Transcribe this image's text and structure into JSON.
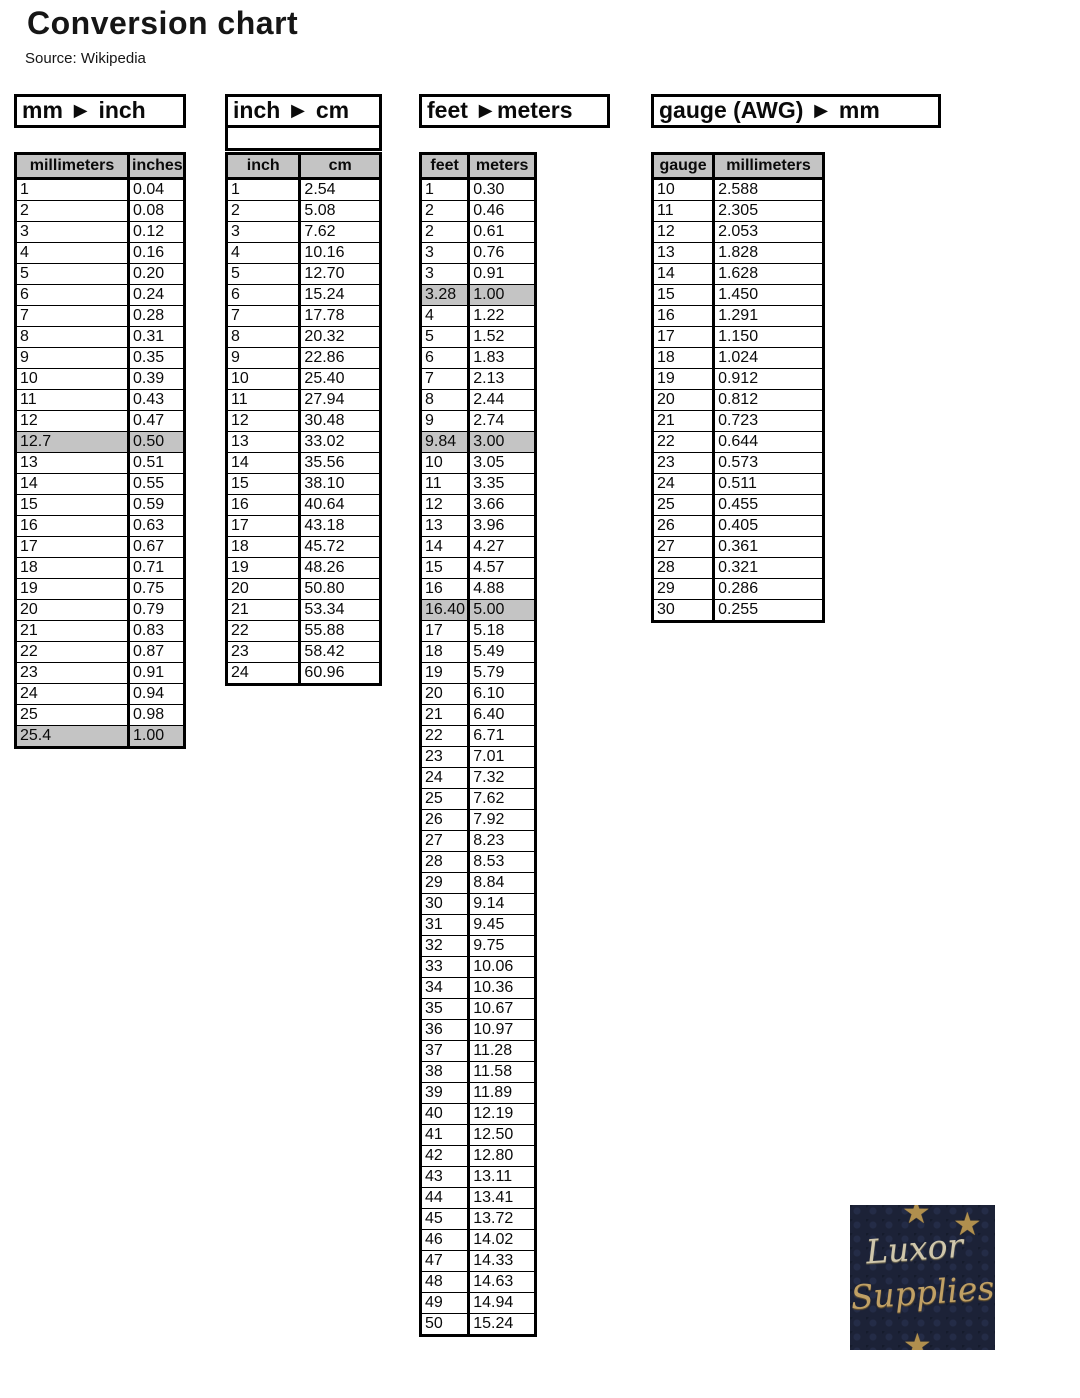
{
  "page": {
    "title": "Conversion chart",
    "source": "Source: Wikipedia"
  },
  "colors": {
    "table_header_bg": "#c4c4c4",
    "highlight_row_bg": "#c4c4c4",
    "border": "#000000",
    "logo_bg": "#1c2237",
    "logo_star": "#b08f4e",
    "logo_text_silver": "#cfc6ab",
    "logo_text_gold": "#c0a065"
  },
  "tables": [
    {
      "id": "mm-inch",
      "title": "mm ► inch",
      "columns": [
        "millimeters",
        "inches"
      ],
      "rows": [
        [
          "1",
          "0.04"
        ],
        [
          "2",
          "0.08"
        ],
        [
          "3",
          "0.12"
        ],
        [
          "4",
          "0.16"
        ],
        [
          "5",
          "0.20"
        ],
        [
          "6",
          "0.24"
        ],
        [
          "7",
          "0.28"
        ],
        [
          "8",
          "0.31"
        ],
        [
          "9",
          "0.35"
        ],
        [
          "10",
          "0.39"
        ],
        [
          "11",
          "0.43"
        ],
        [
          "12",
          "0.47"
        ],
        [
          "12.7",
          "0.50"
        ],
        [
          "13",
          "0.51"
        ],
        [
          "14",
          "0.55"
        ],
        [
          "15",
          "0.59"
        ],
        [
          "16",
          "0.63"
        ],
        [
          "17",
          "0.67"
        ],
        [
          "18",
          "0.71"
        ],
        [
          "19",
          "0.75"
        ],
        [
          "20",
          "0.79"
        ],
        [
          "21",
          "0.83"
        ],
        [
          "22",
          "0.87"
        ],
        [
          "23",
          "0.91"
        ],
        [
          "24",
          "0.94"
        ],
        [
          "25",
          "0.98"
        ],
        [
          "25.4",
          "1.00"
        ]
      ],
      "highlight_rows": [
        12,
        26
      ]
    },
    {
      "id": "inch-cm",
      "title": "inch ► cm",
      "columns": [
        "inch",
        "cm"
      ],
      "rows": [
        [
          "1",
          "2.54"
        ],
        [
          "2",
          "5.08"
        ],
        [
          "3",
          "7.62"
        ],
        [
          "4",
          "10.16"
        ],
        [
          "5",
          "12.70"
        ],
        [
          "6",
          "15.24"
        ],
        [
          "7",
          "17.78"
        ],
        [
          "8",
          "20.32"
        ],
        [
          "9",
          "22.86"
        ],
        [
          "10",
          "25.40"
        ],
        [
          "11",
          "27.94"
        ],
        [
          "12",
          "30.48"
        ],
        [
          "13",
          "33.02"
        ],
        [
          "14",
          "35.56"
        ],
        [
          "15",
          "38.10"
        ],
        [
          "16",
          "40.64"
        ],
        [
          "17",
          "43.18"
        ],
        [
          "18",
          "45.72"
        ],
        [
          "19",
          "48.26"
        ],
        [
          "20",
          "50.80"
        ],
        [
          "21",
          "53.34"
        ],
        [
          "22",
          "55.88"
        ],
        [
          "23",
          "58.42"
        ],
        [
          "24",
          "60.96"
        ]
      ],
      "highlight_rows": []
    },
    {
      "id": "feet-meters",
      "title": "feet ►meters",
      "columns": [
        "feet",
        "meters"
      ],
      "rows": [
        [
          "1",
          "0.30"
        ],
        [
          "2",
          "0.46"
        ],
        [
          "2",
          "0.61"
        ],
        [
          "3",
          "0.76"
        ],
        [
          "3",
          "0.91"
        ],
        [
          "3.28",
          "1.00"
        ],
        [
          "4",
          "1.22"
        ],
        [
          "5",
          "1.52"
        ],
        [
          "6",
          "1.83"
        ],
        [
          "7",
          "2.13"
        ],
        [
          "8",
          "2.44"
        ],
        [
          "9",
          "2.74"
        ],
        [
          "9.84",
          "3.00"
        ],
        [
          "10",
          "3.05"
        ],
        [
          "11",
          "3.35"
        ],
        [
          "12",
          "3.66"
        ],
        [
          "13",
          "3.96"
        ],
        [
          "14",
          "4.27"
        ],
        [
          "15",
          "4.57"
        ],
        [
          "16",
          "4.88"
        ],
        [
          "16.40",
          "5.00"
        ],
        [
          "17",
          "5.18"
        ],
        [
          "18",
          "5.49"
        ],
        [
          "19",
          "5.79"
        ],
        [
          "20",
          "6.10"
        ],
        [
          "21",
          "6.40"
        ],
        [
          "22",
          "6.71"
        ],
        [
          "23",
          "7.01"
        ],
        [
          "24",
          "7.32"
        ],
        [
          "25",
          "7.62"
        ],
        [
          "26",
          "7.92"
        ],
        [
          "27",
          "8.23"
        ],
        [
          "28",
          "8.53"
        ],
        [
          "29",
          "8.84"
        ],
        [
          "30",
          "9.14"
        ],
        [
          "31",
          "9.45"
        ],
        [
          "32",
          "9.75"
        ],
        [
          "33",
          "10.06"
        ],
        [
          "34",
          "10.36"
        ],
        [
          "35",
          "10.67"
        ],
        [
          "36",
          "10.97"
        ],
        [
          "37",
          "11.28"
        ],
        [
          "38",
          "11.58"
        ],
        [
          "39",
          "11.89"
        ],
        [
          "40",
          "12.19"
        ],
        [
          "41",
          "12.50"
        ],
        [
          "42",
          "12.80"
        ],
        [
          "43",
          "13.11"
        ],
        [
          "44",
          "13.41"
        ],
        [
          "45",
          "13.72"
        ],
        [
          "46",
          "14.02"
        ],
        [
          "47",
          "14.33"
        ],
        [
          "48",
          "14.63"
        ],
        [
          "49",
          "14.94"
        ],
        [
          "50",
          "15.24"
        ]
      ],
      "highlight_rows": [
        5,
        12,
        20
      ]
    },
    {
      "id": "gauge-mm",
      "title": "gauge (AWG) ► mm",
      "columns": [
        "gauge",
        "millimeters"
      ],
      "rows": [
        [
          "10",
          "2.588"
        ],
        [
          "11",
          "2.305"
        ],
        [
          "12",
          "2.053"
        ],
        [
          "13",
          "1.828"
        ],
        [
          "14",
          "1.628"
        ],
        [
          "15",
          "1.450"
        ],
        [
          "16",
          "1.291"
        ],
        [
          "17",
          "1.150"
        ],
        [
          "18",
          "1.024"
        ],
        [
          "19",
          "0.912"
        ],
        [
          "20",
          "0.812"
        ],
        [
          "21",
          "0.723"
        ],
        [
          "22",
          "0.644"
        ],
        [
          "23",
          "0.573"
        ],
        [
          "24",
          "0.511"
        ],
        [
          "25",
          "0.455"
        ],
        [
          "26",
          "0.405"
        ],
        [
          "27",
          "0.361"
        ],
        [
          "28",
          "0.321"
        ],
        [
          "29",
          "0.286"
        ],
        [
          "30",
          "0.255"
        ]
      ],
      "highlight_rows": []
    }
  ],
  "logo": {
    "line1": "Luxor",
    "line2": "Supplies",
    "star_glyph": "★"
  }
}
